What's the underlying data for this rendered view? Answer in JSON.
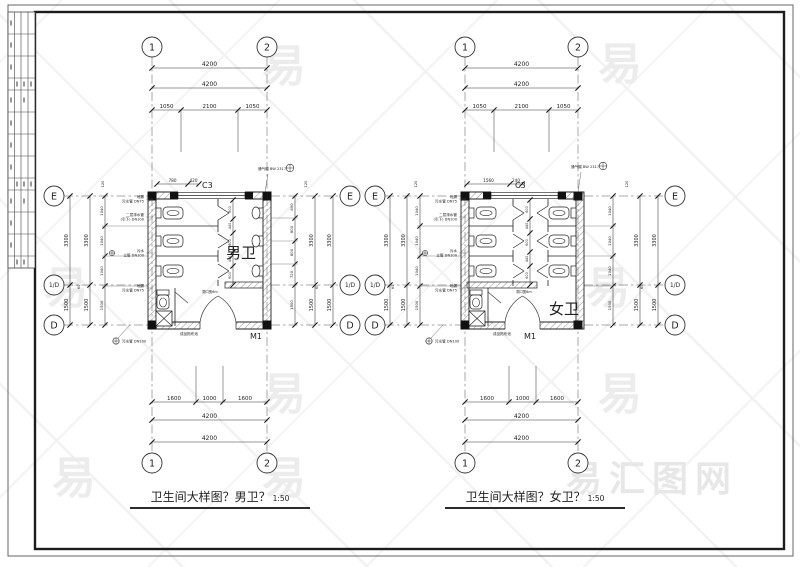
{
  "frame": {
    "watermark_char": "易",
    "watermark_logo": "易汇图网"
  },
  "titles": {
    "men": {
      "text": "卫生间大样图？男卫？",
      "scale": "1:50"
    },
    "women": {
      "text": "卫生间大样图？女卫？",
      "scale": "1:50"
    }
  },
  "plans": [
    {
      "name": "men",
      "room_label": "男卫",
      "window_label": "C3",
      "door_label": "M1",
      "grid_top": [
        "1",
        "2"
      ],
      "grid_bottom": [
        "1",
        "2"
      ],
      "axis_left": [
        "E",
        "1/D",
        "D"
      ],
      "axis_right": [
        "E",
        "1/D",
        "D"
      ],
      "dims_top_overall": [
        "4200",
        "4200"
      ],
      "dims_top_segments": [
        "1050",
        "2100",
        "1050"
      ],
      "dims_bottom_segments": [
        "1600",
        "1000",
        "1600"
      ],
      "dims_bottom_overall": [
        "4200",
        "4200"
      ],
      "dims_left": [
        "3300",
        "1500"
      ],
      "dims_right": [
        "3300",
        "1500"
      ],
      "dims_left_chain": [
        "1040",
        "1040",
        "1040",
        "1500"
      ],
      "dims_right_chain": [
        "600",
        "800",
        "800",
        "720",
        "1500"
      ],
      "dims_window": [
        "780",
        "420"
      ],
      "dims_stall_chain": [
        "600",
        "440",
        "600",
        "440",
        "600"
      ],
      "wall_thickness_label": "120",
      "offset_label": "60",
      "door_width_note": "洞口宽6m",
      "vent_note": "通气帽 BW 2317",
      "floor_note": "成品拖布池",
      "drain_note": "污水管 DN100",
      "annotations_left": [
        [
          "地漏",
          "污水管 DN75"
        ],
        [
          "二层排水管",
          "(引下) DN100"
        ],
        [
          "污水",
          "立管 DN100"
        ],
        [
          "地漏",
          "污水管 DN75"
        ]
      ]
    },
    {
      "name": "women",
      "room_label": "女卫",
      "window_label": "C3",
      "door_label": "M1",
      "grid_top": [
        "1",
        "2"
      ],
      "grid_bottom": [
        "1",
        "2"
      ],
      "axis_left": [
        "E",
        "1/D",
        "D"
      ],
      "axis_right": [
        "E",
        "1/D",
        "D"
      ],
      "dims_top_overall": [
        "4200",
        "4200"
      ],
      "dims_top_segments": [
        "1050",
        "2100",
        "1050"
      ],
      "dims_bottom_segments": [
        "1600",
        "1000",
        "1600"
      ],
      "dims_bottom_overall": [
        "4200",
        "4200"
      ],
      "dims_left": [
        "3300",
        "1500"
      ],
      "dims_right": [
        "3300",
        "1500"
      ],
      "dims_left_chain": [
        "1040",
        "1040",
        "1040",
        "1500"
      ],
      "dims_right_chain": [
        "1040",
        "1040",
        "1040",
        "1500"
      ],
      "dims_window": [
        "1560",
        "240"
      ],
      "dims_stall_chain": [
        "600",
        "440",
        "600",
        "440",
        "600"
      ],
      "wall_thickness_label": "120",
      "offset_label": "60",
      "door_width_note": "洞口宽6m",
      "vent_note": "通气帽 BW 2317",
      "floor_note": "成品拖布池",
      "drain_note": "污水管 DN100",
      "annotations_left": [
        [
          "地漏",
          "污水管 DN75"
        ],
        [
          "二层排水管",
          "(引下) DN100"
        ],
        [
          "污水",
          "立管 DN100"
        ],
        [
          "地漏",
          "污水管 DN75"
        ]
      ]
    }
  ]
}
